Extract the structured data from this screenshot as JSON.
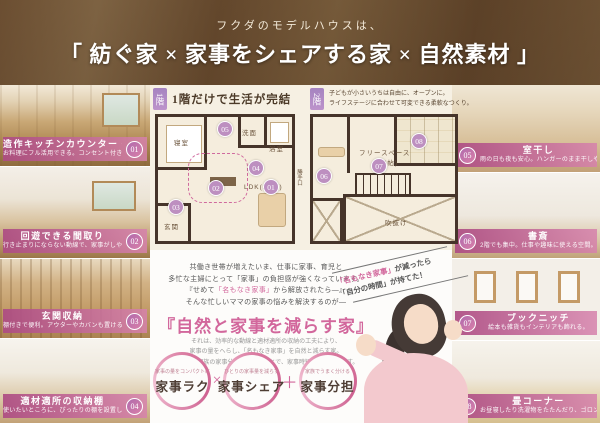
{
  "colors": {
    "accent_pink": "#d2679c",
    "label_bar_pink": "#ad4c83",
    "badge_purple": "#b084be",
    "wall_brown": "#46342a",
    "header_brown": "#7b5a39"
  },
  "header": {
    "subtitle": "フクダのモデルハウスは、",
    "title": "「 紡ぐ家 × 家事をシェアする家 × 自然素材 」"
  },
  "left_features": [
    {
      "num": "01",
      "title": "造作キッチンカウンター・収納",
      "desc": "お料理にフル活用できる。コンセント付きニッチも。"
    },
    {
      "num": "02",
      "title": "回遊できる間取り",
      "desc": "行き止まりにならない動線で、家事がしやすい。"
    },
    {
      "num": "03",
      "title": "玄関収納",
      "desc": "棚付きで便利。アウターやカバンも置ける。"
    },
    {
      "num": "04",
      "title": "適材適所の収納棚",
      "desc": "使いたいところに、ぴったりの棚を設置します。"
    }
  ],
  "right_features": [
    {
      "num": "05",
      "title": "室干し",
      "desc": "雨の日も夜も安心。ハンガーのまま干しやすい。"
    },
    {
      "num": "06",
      "title": "書斎",
      "desc": "2階でも集中。仕事や趣味に使える空間。"
    },
    {
      "num": "07",
      "title": "ブックニッチ",
      "desc": "絵本も雑貨もインテリアも飾れる。"
    },
    {
      "num": "08",
      "title": "畳コーナー",
      "desc": "お昼寝したり洗濯物をたたんだり、ゴロンと過ごせる和の空間。"
    }
  ],
  "floor1": {
    "badge": "1階",
    "title": "1階だけで生活が完結",
    "rooms": {
      "bedroom": "寝室",
      "wash": "洗面",
      "bath": "浴室",
      "ldk": "LDK(21帖)",
      "entrance": "玄関",
      "backdoor": "勝手口"
    },
    "markers": [
      "05",
      "04",
      "02",
      "01",
      "03"
    ]
  },
  "floor2": {
    "badge": "2階",
    "caption1": "子どもが小さいうちは自由に、オープンに。",
    "caption2": "ライフステージに合わせて可変できる柔軟なつくり。",
    "rooms": {
      "free": "フリースペース",
      "free_size": "(16帖)",
      "void": "吹抜け"
    },
    "markers": [
      "08",
      "07",
      "06"
    ]
  },
  "message": {
    "p1a": "共働き世帯が増えたいま、仕事に家事、育児と",
    "p1b": "多忙な主婦にとって「家事」の負担感が強くなっています。",
    "p1c_pre": "『せめて",
    "p1c_pink": "「名もなき家事」",
    "p1c_post": "から解放されたら―』",
    "p1d": "そんな忙しいママの家事の悩みを解決するのが―",
    "title": "『自然と家事を減らす家』",
    "p2a": "それは、効率的な動線と適材適所の収納の工夫により、",
    "p2b": "家事の量をへらし、「名もなき家事」を自然と減らす家。",
    "p2c": "さらに、家族の家事分担も手伝うことで、家事時短効果を高めます。"
  },
  "circles": {
    "items": [
      {
        "small": "家事の量をコンパクトに",
        "label": "家事ラク"
      },
      {
        "small": "ひとりの家事量を減らす",
        "label": "家事シェア"
      },
      {
        "small": "家族でうまく分ける",
        "label": "家事分担"
      }
    ],
    "op1": "×",
    "op2": "＋"
  },
  "callout": {
    "pink": "「名もなき家事」",
    "rest": "が減ったら",
    "line2": "「自分の時間」が持てた！"
  }
}
